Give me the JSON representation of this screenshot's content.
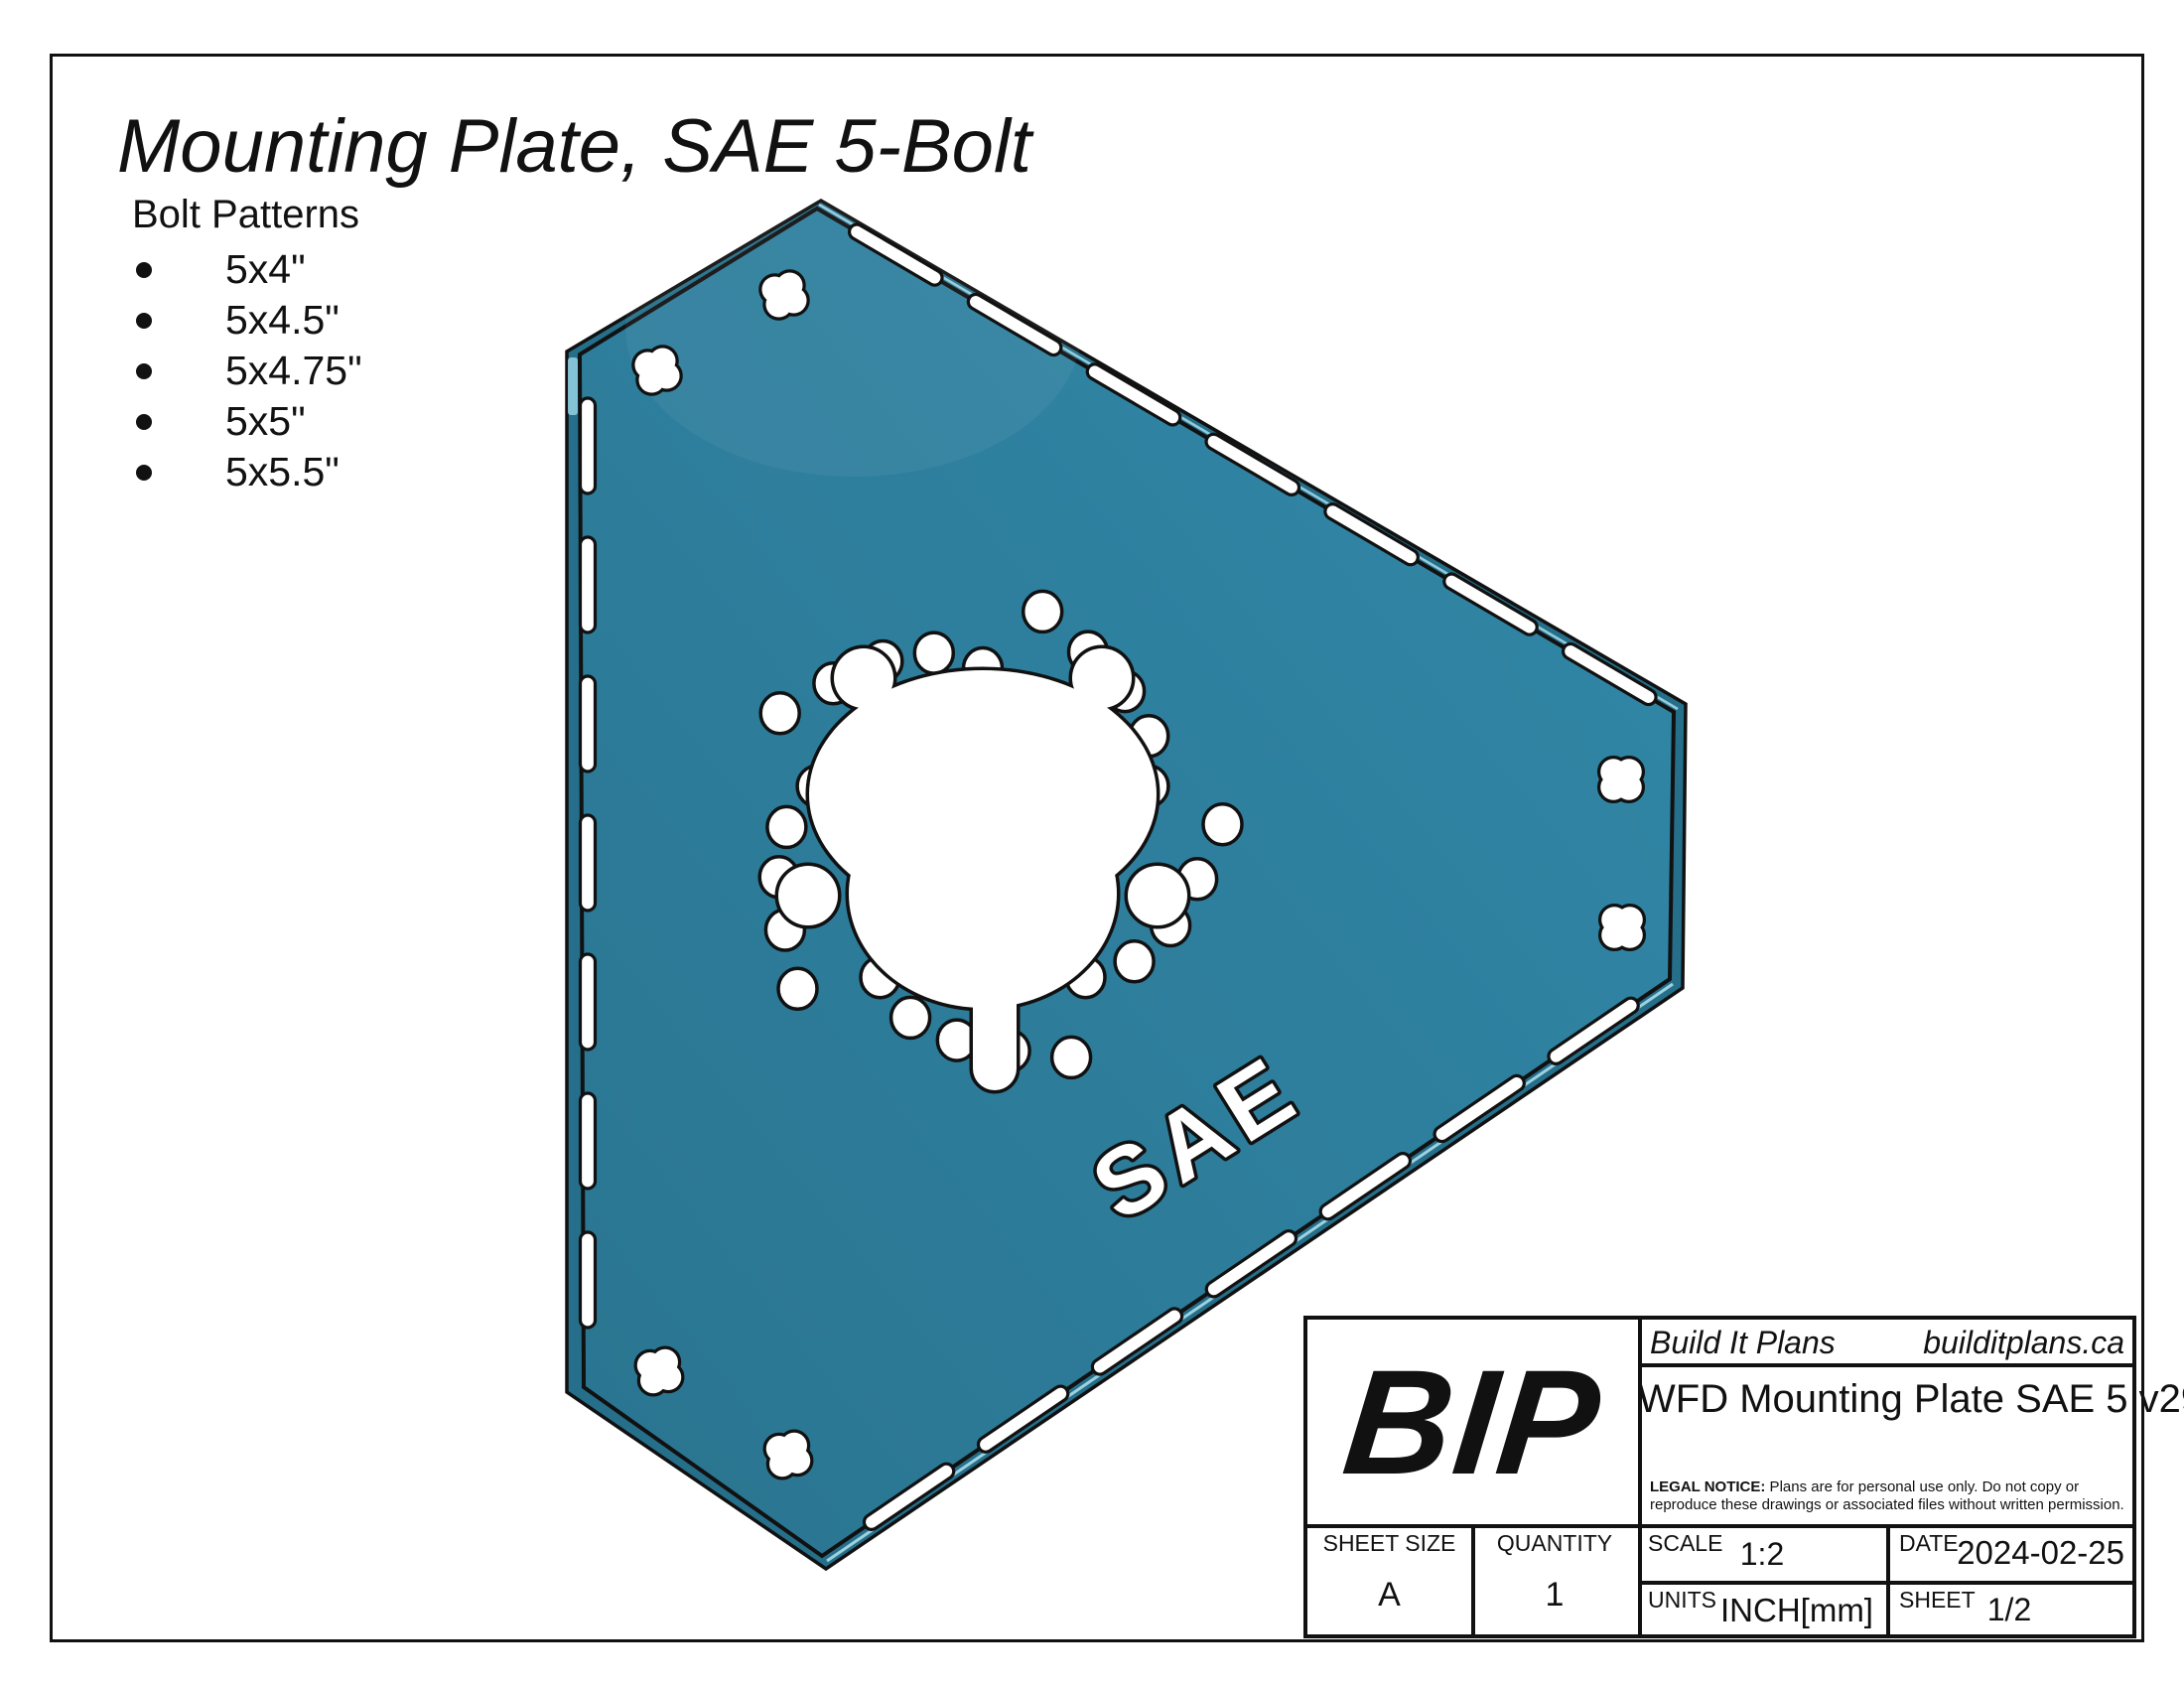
{
  "page": {
    "title": "Mounting Plate, SAE 5-Bolt",
    "bolt_patterns_heading": "Bolt Patterns",
    "bolt_patterns": [
      "5x4\"",
      "5x4.5\"",
      "5x4.75\"",
      "5x5\"",
      "5x5.5\""
    ]
  },
  "plate": {
    "engraving": "SAE",
    "colors": {
      "face": "#2E7F9E",
      "face_light": "#3289A8",
      "face_dark": "#2A7590",
      "edge": "#256F8B",
      "edge_highlight": "#A9DCEA",
      "wall_highlight": "#8FCBDD",
      "outline": "#111111",
      "cutout": "#FFFFFF"
    }
  },
  "title_block": {
    "brand": "Build It Plans",
    "website": "builditplans.ca",
    "logo": "BIP",
    "part_title": "WFD Mounting Plate SAE 5 v29",
    "legal_label": "LEGAL NOTICE:",
    "legal_text": " Plans are for personal use only. Do not copy or reproduce these drawings or associated files without written permission.",
    "sheet_size_label": "SHEET SIZE",
    "sheet_size": "A",
    "quantity_label": "QUANTITY",
    "quantity": "1",
    "scale_label": "SCALE",
    "scale": "1:2",
    "date_label": "DATE",
    "date": "2024-02-25",
    "units_label": "UNITS",
    "units": "INCH[mm]",
    "sheet_label": "SHEET",
    "sheet": "1/2"
  }
}
